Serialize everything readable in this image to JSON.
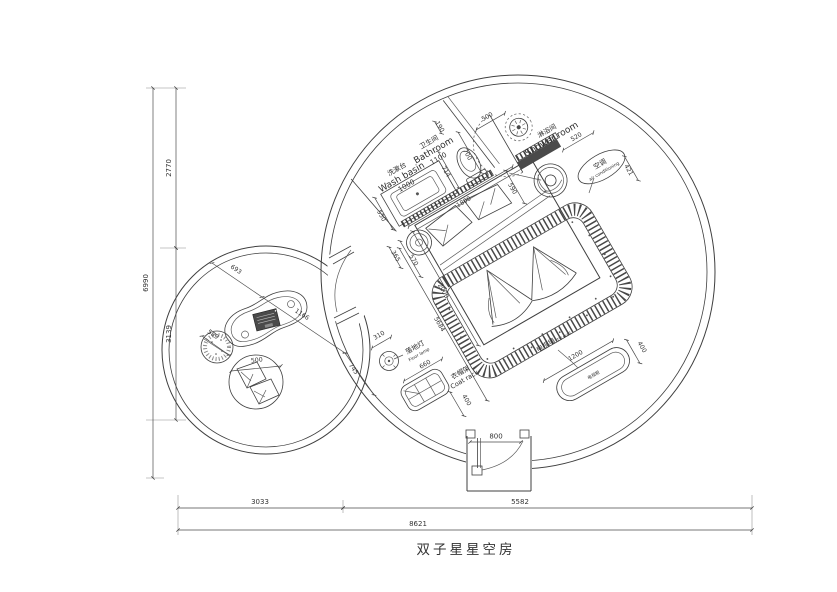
{
  "title": "双子星星空房",
  "plan": {
    "bathroom": {
      "cn": "卫生间",
      "en": "Bathroom",
      "width": "1100"
    },
    "washbasin": {
      "cn": "洗漱台",
      "en": "Wash basin",
      "width": "1000"
    },
    "shower": {
      "cn": "淋浴间",
      "en": "Shower room"
    },
    "ac": {
      "cn": "空调",
      "en": "air conditioning"
    },
    "floor_lamp": {
      "cn": "落地灯",
      "en": "Floor lamp"
    },
    "coat_rack": {
      "cn": "衣帽架",
      "en": "Coat rack"
    },
    "tv_wall": {
      "cn": "电视墙",
      "en": "TV wall"
    },
    "tv_cabinet": {
      "cn": "电视柜"
    }
  },
  "dims": {
    "left_top": "2770",
    "left_bottom": "3139",
    "left_total": "6990",
    "bottom_left": "3033",
    "bottom_right": "5582",
    "bottom_total": "8621",
    "entry_door": "800",
    "wall_stub": "190",
    "bath_door": "700",
    "shower_door": "500",
    "basin_depth": "550",
    "toilet_niche": "714",
    "wall_run": "1800",
    "door_side": "590",
    "bench": "520",
    "ac_clear": "421",
    "bed_width": "2000",
    "room_diag": "5684",
    "bedside_dia": "365",
    "bedside_clear": "570",
    "lamp_dia": "310",
    "rack_width": "660",
    "rack_depth": "400",
    "tv_width": "1200",
    "tv_depth": "400",
    "sofa_off": "693",
    "table_len": "1166",
    "table_clear": "745",
    "stool_dia": "589",
    "cushion_dia": "500"
  },
  "colors": {
    "line": "#3f3f3f",
    "fill_dark": "#4a4a4a",
    "background": "#ffffff"
  }
}
